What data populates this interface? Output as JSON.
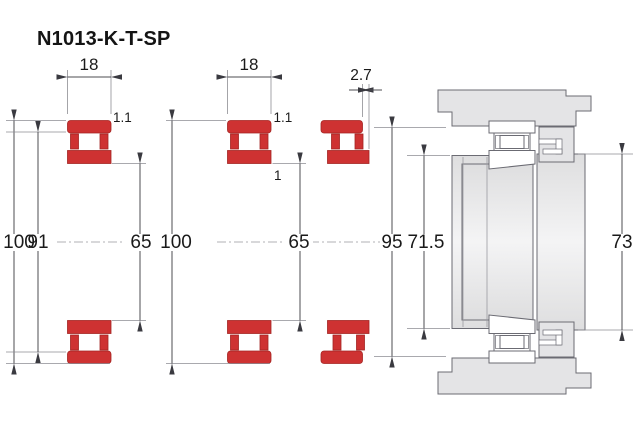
{
  "title": "N1013-K-T-SP",
  "figures": {
    "front": {
      "width": "18",
      "chamfer": "1.1",
      "outer_diameter": "100",
      "rib_diameter": "91",
      "bore_diameter": "65"
    },
    "tapered": {
      "width": "18",
      "chamfer": "1.1",
      "chamfer_inner": "1",
      "outer_diameter": "100",
      "bore_diameter": "65"
    },
    "displaced": {
      "axial_offset": "2.7",
      "raceway_diameter": "95"
    }
  },
  "mounting": {
    "abutment_diameter": "71.5",
    "shoulder_diameter": "73"
  },
  "colors": {
    "ring_red": "#ce3232",
    "steel_grey": "#e4e4e6",
    "dimension_line": "#4c4c52"
  }
}
